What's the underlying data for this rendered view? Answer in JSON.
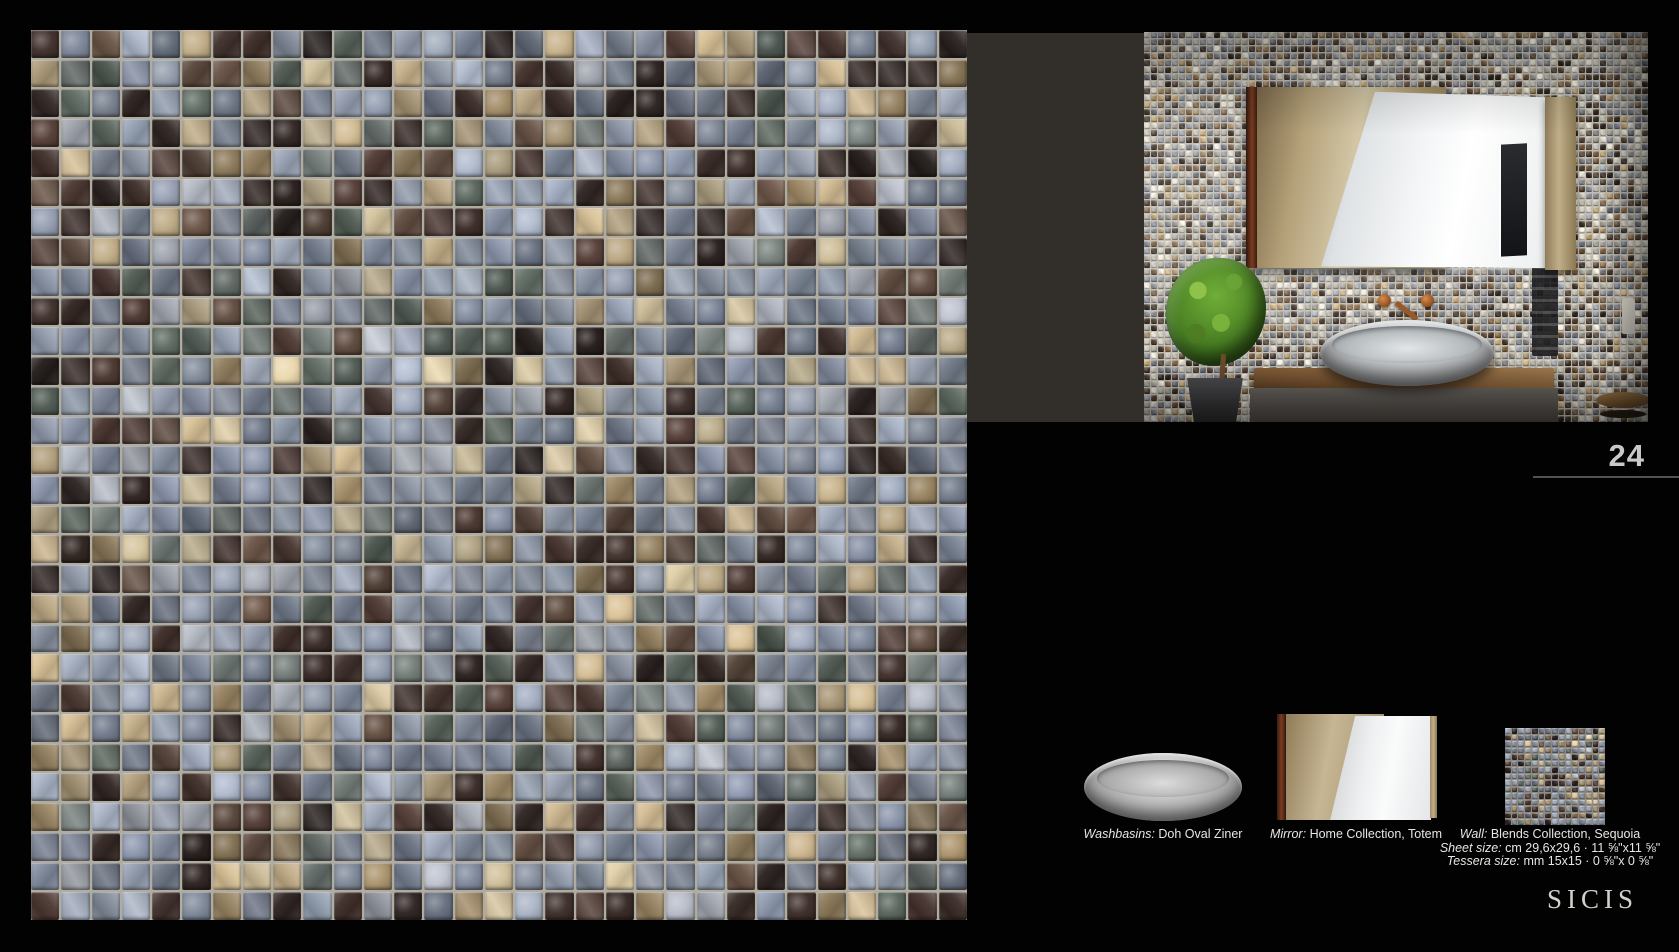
{
  "page": {
    "number": "24",
    "brand_logo": "SICIS"
  },
  "captions": {
    "washbasin": {
      "label": "Washbasins:",
      "value": "Doh Oval Ziner"
    },
    "mirror": {
      "label": "Mirror:",
      "value": "Home Collection, Totem"
    },
    "wall": {
      "label": "Wall:",
      "value": "Blends Collection, Sequoia"
    },
    "sheet": {
      "label": "Sheet size:",
      "value": "cm 29,6x29,6 · 11 ⅝\"x11 ⅝\""
    },
    "tessera": {
      "label": "Tessera size:",
      "value": "mm 15x15 · 0 ⅝\"x 0 ⅝\""
    }
  },
  "colors": {
    "background": "#020202",
    "band": "#322e2a",
    "page_number": "#c9c9c9",
    "rule_line": "#55524e",
    "caption_text": "#e8e6e2",
    "logo_text": "#d3d0ca"
  },
  "mosaics": {
    "main_swatch": {
      "cols": 31,
      "rows": 30,
      "gap": 2,
      "grout": "#b0aca0",
      "seed": 42,
      "tileClass": "gt",
      "palette": [
        "#8e97a8",
        "#7c8598",
        "#9aa3b3",
        "#6e7787",
        "#a9aeb8",
        "#392b27",
        "#2a211f",
        "#4a3630",
        "#5e4a3e",
        "#baa682",
        "#c9b995",
        "#937f5e",
        "#556058",
        "#6b7470",
        "#818b9b"
      ],
      "weights": [
        0.1,
        0.1,
        0.09,
        0.07,
        0.05,
        0.08,
        0.06,
        0.07,
        0.04,
        0.06,
        0.05,
        0.05,
        0.05,
        0.04,
        0.09
      ]
    },
    "photo_wall": {
      "cols": 72,
      "rows": 56,
      "gap": 1,
      "grout": "#c2bcae",
      "seed": 1337,
      "tileClass": "pt",
      "palette": [
        "#ddd8cb",
        "#c7c2b6",
        "#aaa79d",
        "#92969f",
        "#757b87",
        "#4e3d30",
        "#352a22",
        "#7d5f40",
        "#bb9d6e",
        "#8d8f94"
      ],
      "weights": [
        0.14,
        0.12,
        0.1,
        0.11,
        0.08,
        0.12,
        0.09,
        0.08,
        0.07,
        0.09
      ]
    },
    "mini_swatch": {
      "cols": 15,
      "rows": 15,
      "gap": 1,
      "grout": "#8e8a80",
      "seed": 7,
      "tileClass": "mt",
      "palette": [
        "#8e97a8",
        "#7c8598",
        "#9aa3b3",
        "#6e7787",
        "#a9aeb8",
        "#392b27",
        "#2a211f",
        "#4a3630",
        "#5e4a3e",
        "#baa682",
        "#c9b995",
        "#937f5e",
        "#556058",
        "#6b7470",
        "#818b9b"
      ],
      "weights": [
        0.1,
        0.1,
        0.09,
        0.07,
        0.05,
        0.08,
        0.06,
        0.07,
        0.04,
        0.06,
        0.05,
        0.05,
        0.05,
        0.04,
        0.09
      ]
    }
  }
}
